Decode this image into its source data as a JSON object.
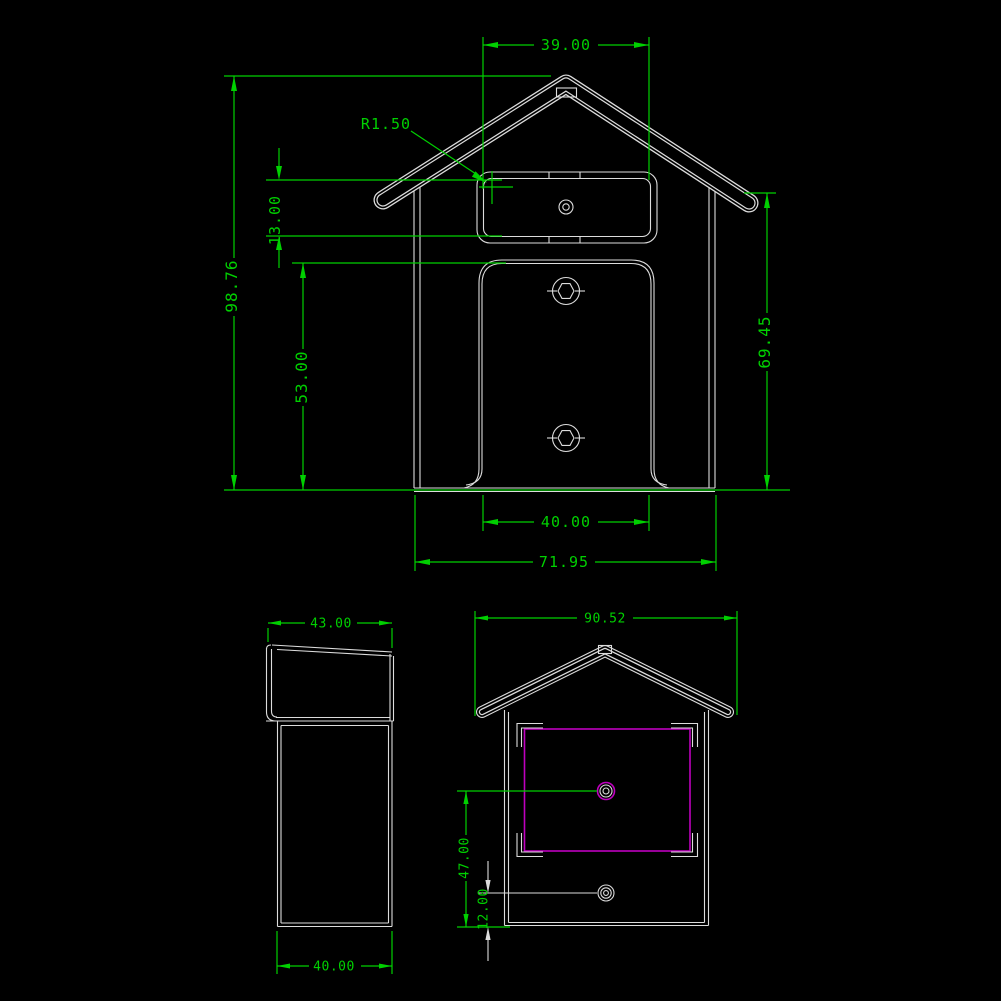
{
  "background_color": "#000000",
  "colors": {
    "dimension_green": "#00d000",
    "outline_white": "#dcdcdc",
    "highlight_magenta": "#bf00bf"
  },
  "front_view": {
    "dim_top_width": "39.00",
    "dim_corner_radius": "R1.50",
    "dim_slot_height": "13.00",
    "dim_overall_height": "98.76",
    "dim_panel_height": "53.00",
    "dim_right_height": "69.45",
    "dim_inner_width": "40.00",
    "dim_overall_width": "71.95"
  },
  "side_view": {
    "dim_top_depth": "43.00",
    "dim_bottom_depth": "40.00"
  },
  "rear_view": {
    "dim_overall_width": "90.52",
    "dim_upper_hole_height": "47.00",
    "dim_lower_hole_height": "12.00"
  }
}
